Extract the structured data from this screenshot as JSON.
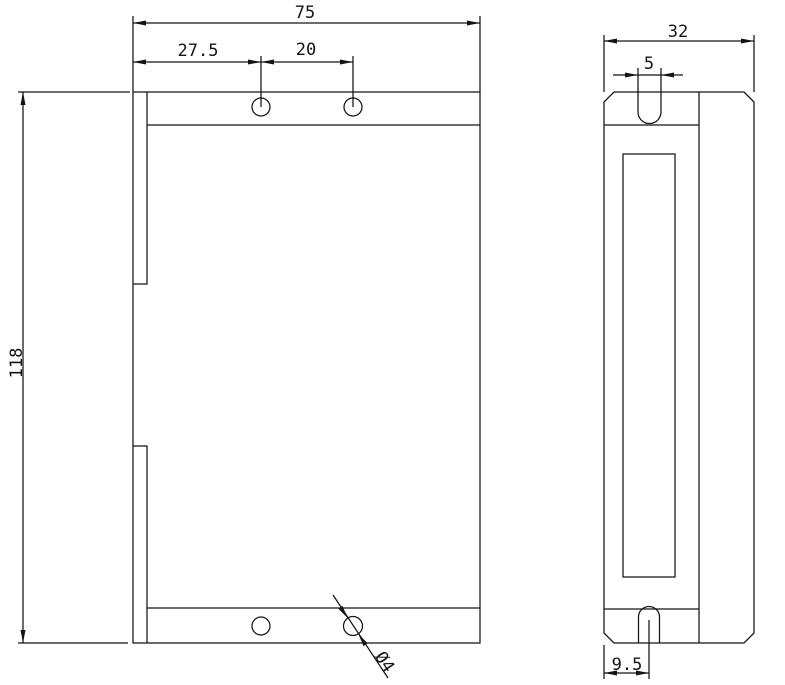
{
  "page": {
    "background": "#ffffff",
    "line_color": "#141414"
  },
  "front_view": {
    "title": "front-view-of-driver-enclosure",
    "dim_overall_width": "75",
    "dim_hole_offset": "27.5",
    "dim_hole_pitch": "20",
    "dim_overall_height": "118",
    "dim_hole_diameter": "Ø4"
  },
  "side_view": {
    "title": "side-view-of-driver-enclosure",
    "dim_overall_depth": "32",
    "dim_top_slot_width": "5",
    "dim_bottom_slot_offset": "9.5"
  }
}
